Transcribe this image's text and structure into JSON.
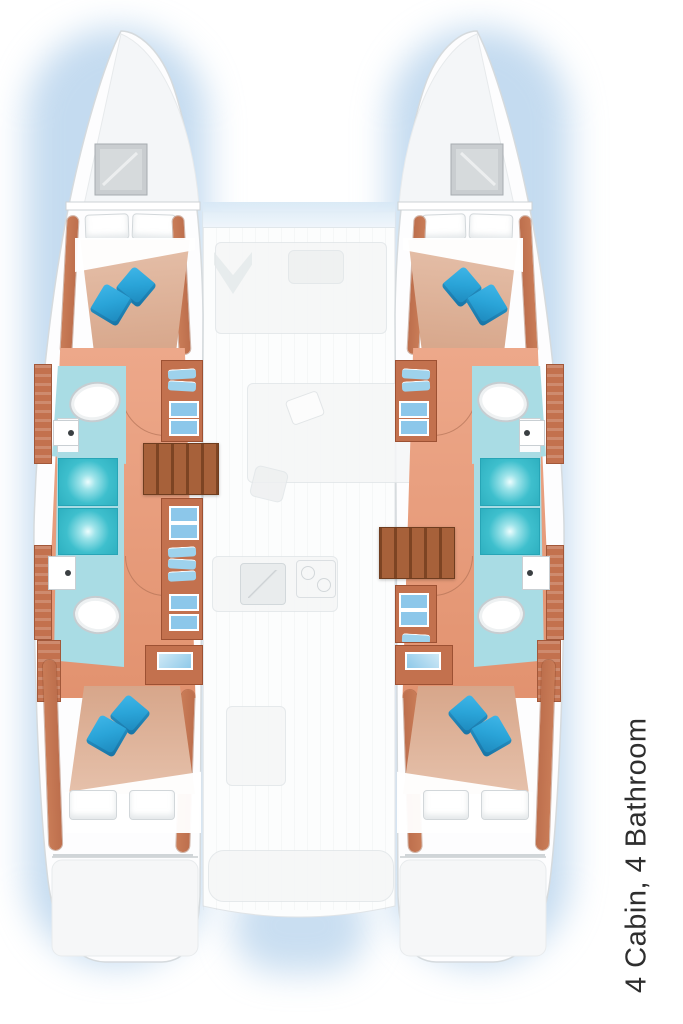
{
  "caption": {
    "text": "4 Cabin, 4 Bathroom"
  },
  "palette": {
    "hull_fill": "#fdfdfe",
    "hull_stroke": "#d5dadd",
    "hatch_gray": "#c9cdd0",
    "floor_salmon": "#e2926f",
    "bed_blanket": "#d7a68a",
    "bed_blanket_light": "#e6c1ab",
    "wood_trim": "#bd6f4d",
    "wood_cabinet": "#c3714e",
    "stairs_wood": "#9c5a33",
    "bath_floor": "#a9dce4",
    "shower_teal": "#3ebfcd",
    "pillow_blue": "#2aa4d8",
    "pillow_blue_dark": "#1b84b8",
    "ghost_fill": "#f5f6f7",
    "ghost_line": "#e2e6e8",
    "halo_blue": "#94bde4",
    "windshield_blue": "#d7e8f6",
    "caption_color": "#2e2e2e"
  }
}
